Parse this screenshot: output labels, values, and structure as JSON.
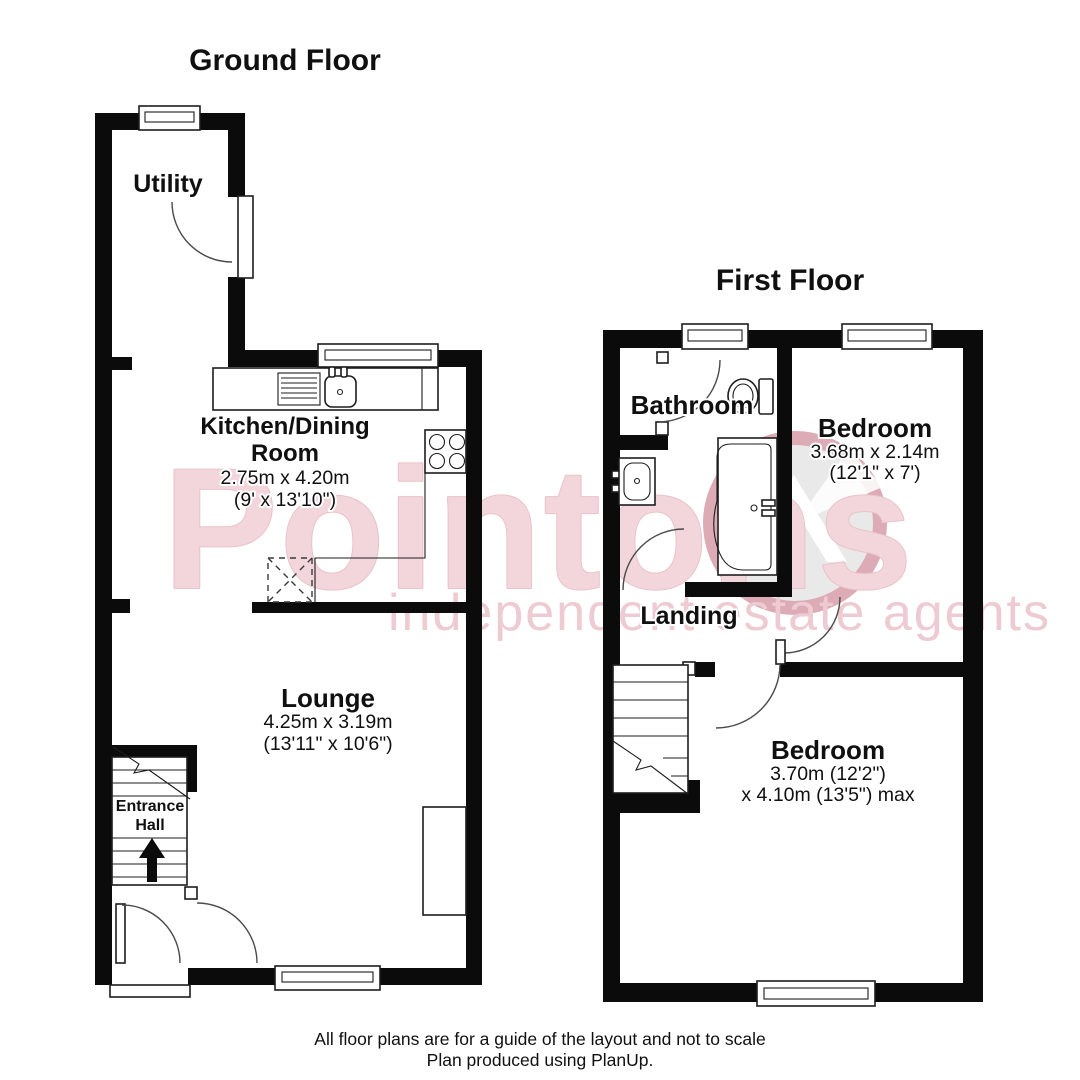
{
  "ground_floor": {
    "title": "Ground Floor",
    "rooms": [
      {
        "name": "Utility"
      },
      {
        "name": "Kitchen/Dining Room",
        "line1": "Kitchen/Dining",
        "line2": "Room",
        "dims_metric": "2.75m x 4.20m",
        "dims_imperial": "(9' x 13'10\")"
      },
      {
        "name": "Lounge",
        "dims_metric": "4.25m x 3.19m",
        "dims_imperial": "(13'11\" x 10'6\")"
      },
      {
        "name": "Entrance Hall",
        "line1": "Entrance",
        "line2": "Hall"
      }
    ]
  },
  "first_floor": {
    "title": "First Floor",
    "rooms": [
      {
        "name": "Bathroom"
      },
      {
        "name": "Bedroom",
        "dims_metric": "3.68m x 2.14m",
        "dims_imperial": "(12'1\" x 7')"
      },
      {
        "name": "Landing"
      },
      {
        "name": "Bedroom",
        "dims_line1": "3.70m (12'2\")",
        "dims_line2": "x 4.10m (13'5\") max"
      }
    ]
  },
  "watermark": {
    "brand": "Pointons",
    "tagline": "independent estate agents",
    "colors": {
      "brand_fill": "#f2d6db",
      "brand_edge": "#e9c3ca",
      "tagline_fill": "#eecbd2",
      "logo_ring": "#dcabb6",
      "logo_inner": "#e9e9e9"
    }
  },
  "footer": {
    "line1": "All floor plans are for a guide of the layout and not to scale",
    "line2": "Plan produced using PlanUp."
  }
}
